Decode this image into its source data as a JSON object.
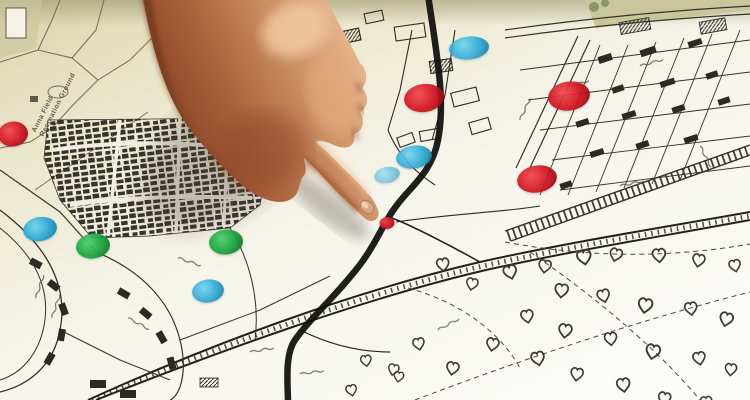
{
  "scene": {
    "type": "photograph",
    "description": "A hand with index finger extended points to a spot on a printed street map; the map is dotted with round red, green and blue location markers and a thick black route line.",
    "hand": "pointing-hand-index-finger-touching-map"
  },
  "map": {
    "label_line1": "Anna Field",
    "label_line2": "Recreation Ground"
  },
  "marker_colors": {
    "red": {
      "light": "#f04a50",
      "base": "#cd1320",
      "dark": "#8e0a14"
    },
    "green": {
      "light": "#4ecf6e",
      "base": "#17a03c",
      "dark": "#0b6e28"
    },
    "blue": {
      "light": "#6fd4ef",
      "base": "#27a3d2",
      "dark": "#147ba6"
    }
  },
  "markers": [
    {
      "color": "red",
      "x": 13,
      "y": 134,
      "w": 30,
      "h": 25,
      "rot": -8,
      "opacity": 0.95
    },
    {
      "color": "blue",
      "x": 40,
      "y": 229,
      "w": 34,
      "h": 24,
      "rot": -10,
      "opacity": 0.95
    },
    {
      "color": "green",
      "x": 93,
      "y": 246,
      "w": 34,
      "h": 25,
      "rot": -8,
      "opacity": 0.95
    },
    {
      "color": "green",
      "x": 226,
      "y": 242,
      "w": 34,
      "h": 25,
      "rot": -6,
      "opacity": 0.95
    },
    {
      "color": "blue",
      "x": 208,
      "y": 291,
      "w": 32,
      "h": 23,
      "rot": -8,
      "opacity": 0.9
    },
    {
      "color": "green",
      "x": 329,
      "y": 69,
      "w": 38,
      "h": 27,
      "rot": -10,
      "opacity": 0.95
    },
    {
      "color": "red",
      "x": 424,
      "y": 98,
      "w": 40,
      "h": 28,
      "rot": -8,
      "opacity": 0.95
    },
    {
      "color": "blue",
      "x": 469,
      "y": 48,
      "w": 40,
      "h": 23,
      "rot": -6,
      "opacity": 0.9
    },
    {
      "color": "blue",
      "x": 414,
      "y": 157,
      "w": 36,
      "h": 23,
      "rot": -8,
      "opacity": 0.9
    },
    {
      "color": "blue",
      "x": 387,
      "y": 175,
      "w": 26,
      "h": 16,
      "rot": -12,
      "opacity": 0.55
    },
    {
      "color": "red",
      "x": 569,
      "y": 96,
      "w": 42,
      "h": 29,
      "rot": -8,
      "opacity": 0.95
    },
    {
      "color": "red",
      "x": 537,
      "y": 179,
      "w": 40,
      "h": 27,
      "rot": -10,
      "opacity": 0.95
    },
    {
      "color": "red",
      "x": 387,
      "y": 223,
      "w": 15,
      "h": 12,
      "rot": -5,
      "opacity": 0.95
    }
  ]
}
